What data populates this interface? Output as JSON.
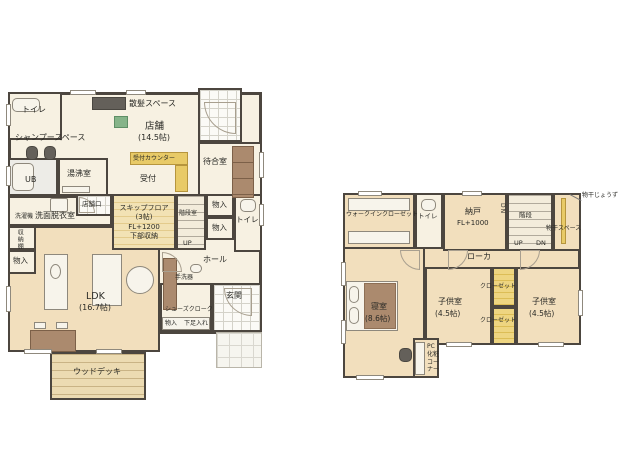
{
  "document": {
    "type": "floor-plan",
    "background": "#ffffff"
  },
  "colors": {
    "wall": "#4c463f",
    "floor_cream": "#f7f1e2",
    "floor_wood": "#f2dfbd",
    "counter_yellow": "#e8ca67",
    "furniture_brown": "#ab8a6e",
    "mat_green": "#86b489"
  },
  "floor1": {
    "toilet": "トイレ",
    "haircut_space": "散髪スペース",
    "shampoo_space": "シャンプースペース",
    "shop": "店舗",
    "shop_size": "(14.5帖)",
    "waiting_room": "待合室",
    "reception_counter": "受付カウンター",
    "reception": "受付",
    "ub": "UB",
    "kitchenette": "湯沸室",
    "shop_door": "店舗口",
    "washing_machine": "洗濯機",
    "washroom": "洗面脱衣室",
    "storage_shelf": "収納棚",
    "storage_left": "物入",
    "skip_floor": "スキップフロア",
    "skip_floor_size": "(3帖)",
    "skip_floor_level": "FL+1200",
    "skip_floor_note": "下部収納",
    "stair_room": "階段室",
    "storage_top": "物入",
    "storage_mid": "物入",
    "toilet2": "トイレ",
    "up": "UP",
    "hall": "ホール",
    "hand_basin": "手洗器",
    "entrance": "玄関",
    "shoes_closet": "シューズクローク",
    "storage_bottom": "物入",
    "shoe_rack": "下足入れ",
    "ldk": "LDK",
    "ldk_size": "(16.7帖)",
    "wood_deck": "ウッドデッキ"
  },
  "floor2": {
    "walk_in_closet": "ウォークインクローゼット",
    "toilet": "トイレ",
    "storage_room": "納戸",
    "storage_room_level": "FL+1000",
    "stairs": "階段",
    "dn_wall": "DN",
    "up": "UP",
    "dn": "DN",
    "drying_space": "物干スペース",
    "drying_pole": "物干じょうず",
    "corridor": "ローカ",
    "bedroom": "寝室",
    "bedroom_size": "(8.6帖)",
    "kids_room1": "子供室",
    "kids_room1_size": "(4.5帖)",
    "closet1": "クローゼット",
    "closet2": "クローゼット",
    "kids_room2": "子供室",
    "kids_room2_size": "(4.5帖)",
    "pc_line1": "PC",
    "pc_line2": "化粧",
    "pc_line3": "コーナー"
  }
}
